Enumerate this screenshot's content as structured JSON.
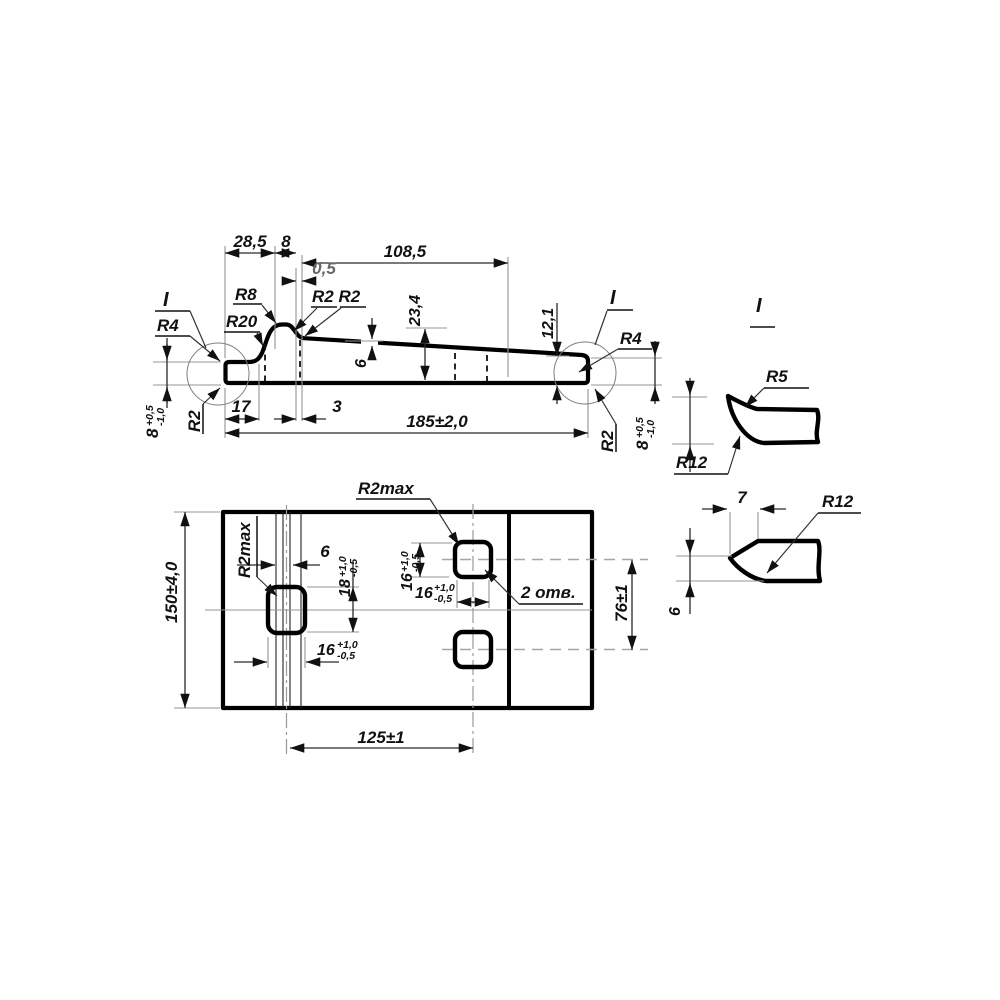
{
  "drawing_title": "bracket-plate technical drawing",
  "side_view": {
    "d28_5": "28,5",
    "d8": "8",
    "d108_5": "108,5",
    "d0_5": "0,5",
    "d23_4": "23,4",
    "d6": "6",
    "d12_1": "12,1",
    "d17": "17",
    "d3": "3",
    "d185": "185±2,0",
    "r4_left": "R4",
    "r20": "R20",
    "r8": "R8",
    "r2_pair": "R2 R2",
    "r2_left": "R2",
    "r2_right": "R2",
    "r4_right": "R4",
    "mark_left": "I",
    "mark_right": "I"
  },
  "tol8": {
    "v": "8",
    "up": "+0,5",
    "dn": "-1,0"
  },
  "tol16": {
    "v": "16",
    "up": "+1,0",
    "dn": "-0,5"
  },
  "tol18": {
    "v": "18",
    "up": "+1,0",
    "dn": "-0,5"
  },
  "plan_view": {
    "d150": "150±4,0",
    "r2max_side": "R2max",
    "r2max_top": "R2max",
    "d6": "6",
    "holes_note": "2 отв.",
    "d76": "76±1",
    "d125": "125±1"
  },
  "details": {
    "title": "I",
    "r5": "R5",
    "r12_hook": "R12",
    "d7": "7",
    "r12_point": "R12",
    "d6": "6"
  }
}
